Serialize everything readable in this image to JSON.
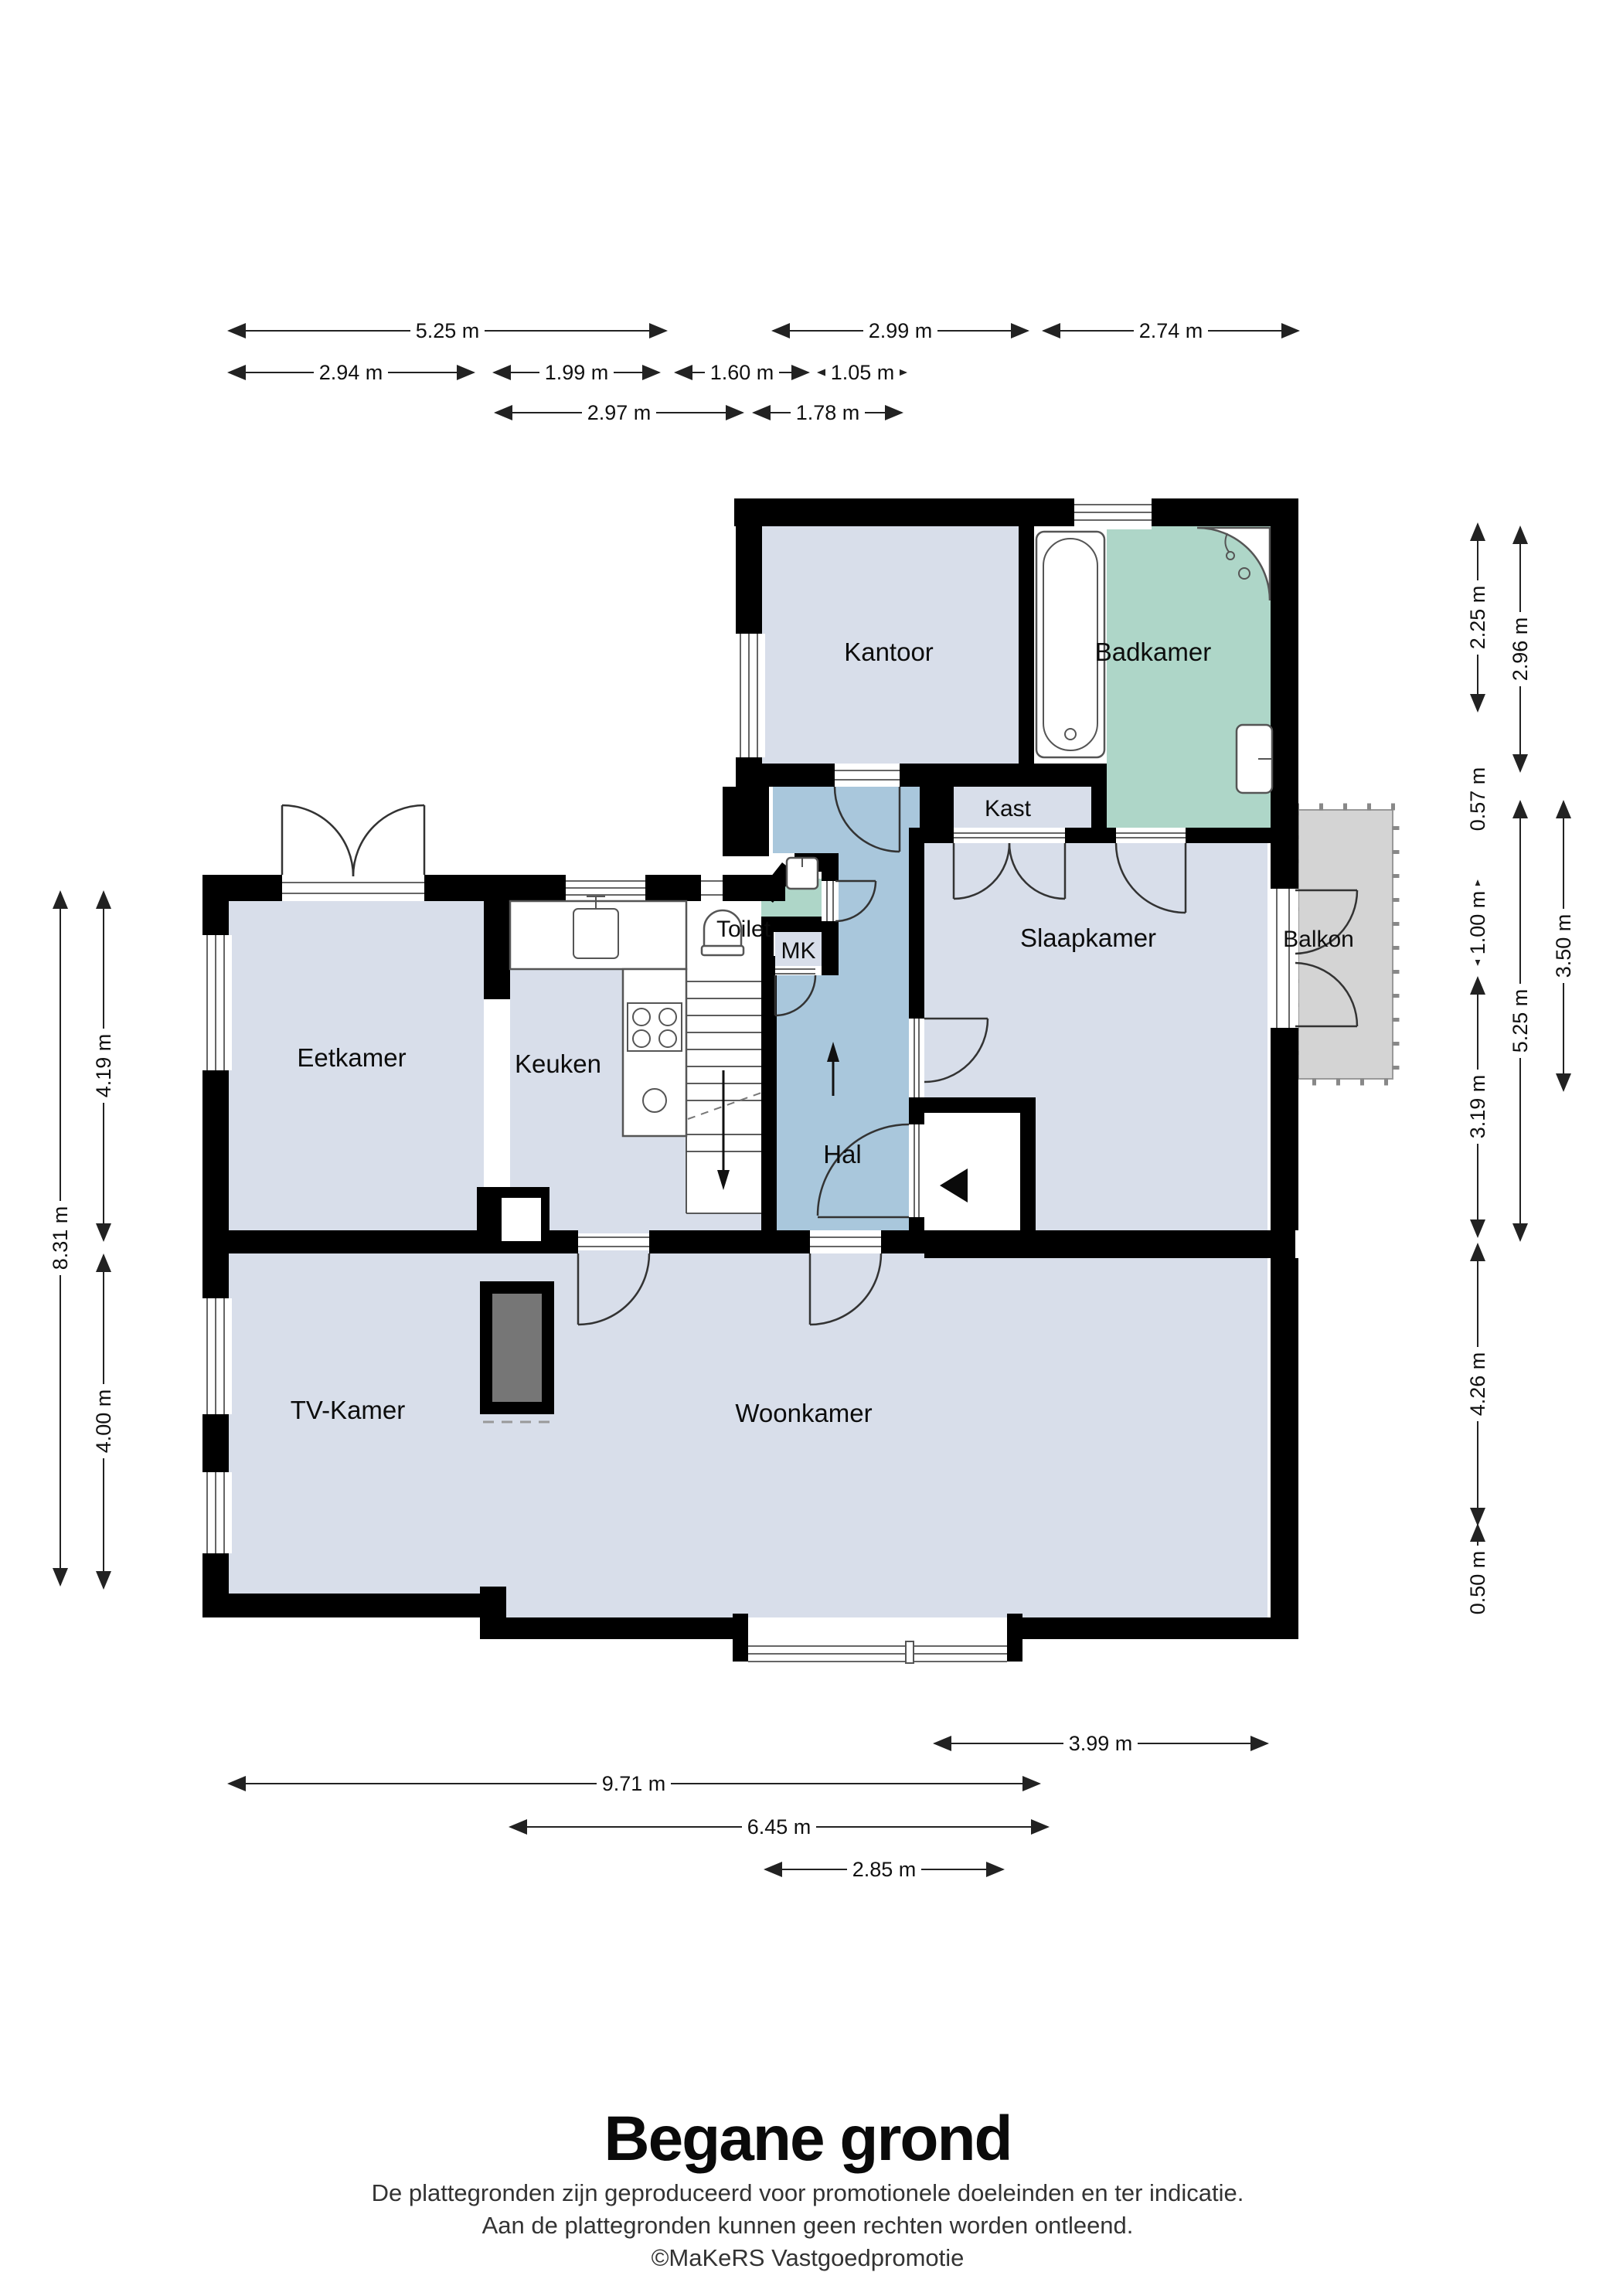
{
  "title": "Begane grond",
  "disclaimer": {
    "line1": "De plattegronden zijn geproduceerd voor promotionele doeleinden en ter indicatie.",
    "line2": "Aan de plattegronden kunnen geen rechten worden ontleend.",
    "line3": "©MaKeRS Vastgoedpromotie"
  },
  "rooms": {
    "kantoor": "Kantoor",
    "badkamer": "Badkamer",
    "kast": "Kast",
    "toilet": "Toilet",
    "mk": "MK",
    "slaapkamer": "Slaapkamer",
    "balkon": "Balkon",
    "eetkamer": "Eetkamer",
    "keuken": "Keuken",
    "hal": "Hal",
    "tvkamer": "TV-Kamer",
    "woonkamer": "Woonkamer"
  },
  "dimensions": {
    "top": [
      "5.25 m",
      "2.99 m",
      "2.74 m",
      "2.94 m",
      "1.99 m",
      "1.60 m",
      "1.05 m",
      "2.97 m",
      "1.78 m"
    ],
    "right": [
      "2.25 m",
      "2.96 m",
      "0.57 m",
      "1.00 m",
      "3.19 m",
      "5.25 m",
      "3.50 m",
      "4.26 m",
      "0.50 m"
    ],
    "left": [
      "8.31 m",
      "4.19 m",
      "4.00 m"
    ],
    "bottom": [
      "3.99 m",
      "9.71 m",
      "6.45 m",
      "2.85 m"
    ]
  },
  "colors": {
    "room": "#d8deea",
    "hall": "#a9c7dc",
    "wet": "#aed6c8",
    "balkon": "#d4d4d4",
    "fireplace": "#767676",
    "wall": "#000000"
  },
  "icons": {
    "entrance_arrow": "entrance direction arrow",
    "stairs_up": "stairs up arrow",
    "stairs_down": "stairs down arrow"
  }
}
